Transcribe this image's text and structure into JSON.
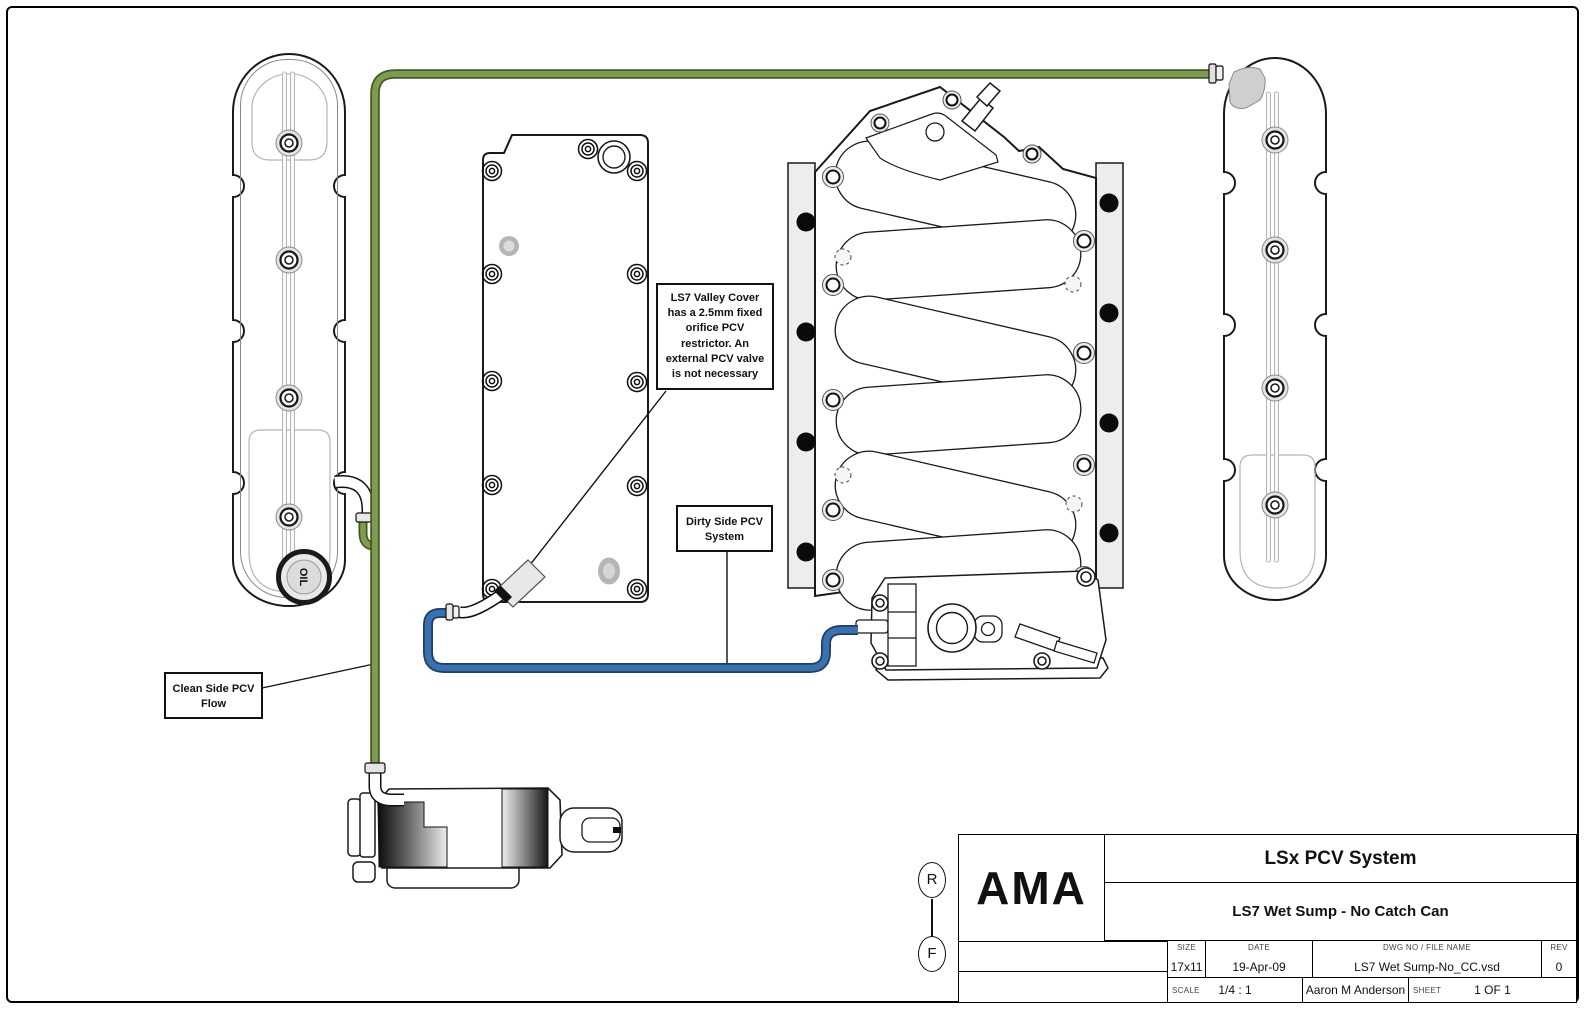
{
  "annotations": {
    "valley_cover_note": "LS7 Valley Cover has a 2.5mm fixed orifice PCV restrictor. An external PCV valve is not necessary",
    "dirty_side_label": "Dirty Side PCV System",
    "clean_side_label": "Clean Side PCV Flow"
  },
  "parts": {
    "oil_cap_label": "OIL",
    "clean_hose_color": "#7d9b52",
    "clean_hose_outline": "#44591f",
    "dirty_hose_color": "#3a70ad",
    "dirty_hose_outline": "#1d3f66"
  },
  "zone_markers": {
    "top": "R",
    "bottom": "F"
  },
  "title_block": {
    "logo": "AMA",
    "title": "LSx PCV System",
    "subtitle": "LS7 Wet Sump - No Catch Can",
    "size_label": "SIZE",
    "size_value": "17x11",
    "date_label": "DATE",
    "date_value": "19-Apr-09",
    "dwg_label": "DWG NO / FILE NAME",
    "dwg_value": "LS7 Wet Sump-No_CC.vsd",
    "rev_label": "REV",
    "rev_value": "0",
    "scale_label": "SCALE",
    "scale_value": "1/4 : 1",
    "author": "Aaron M Anderson",
    "sheet_label": "SHEET",
    "sheet_value": "1 OF 1"
  }
}
